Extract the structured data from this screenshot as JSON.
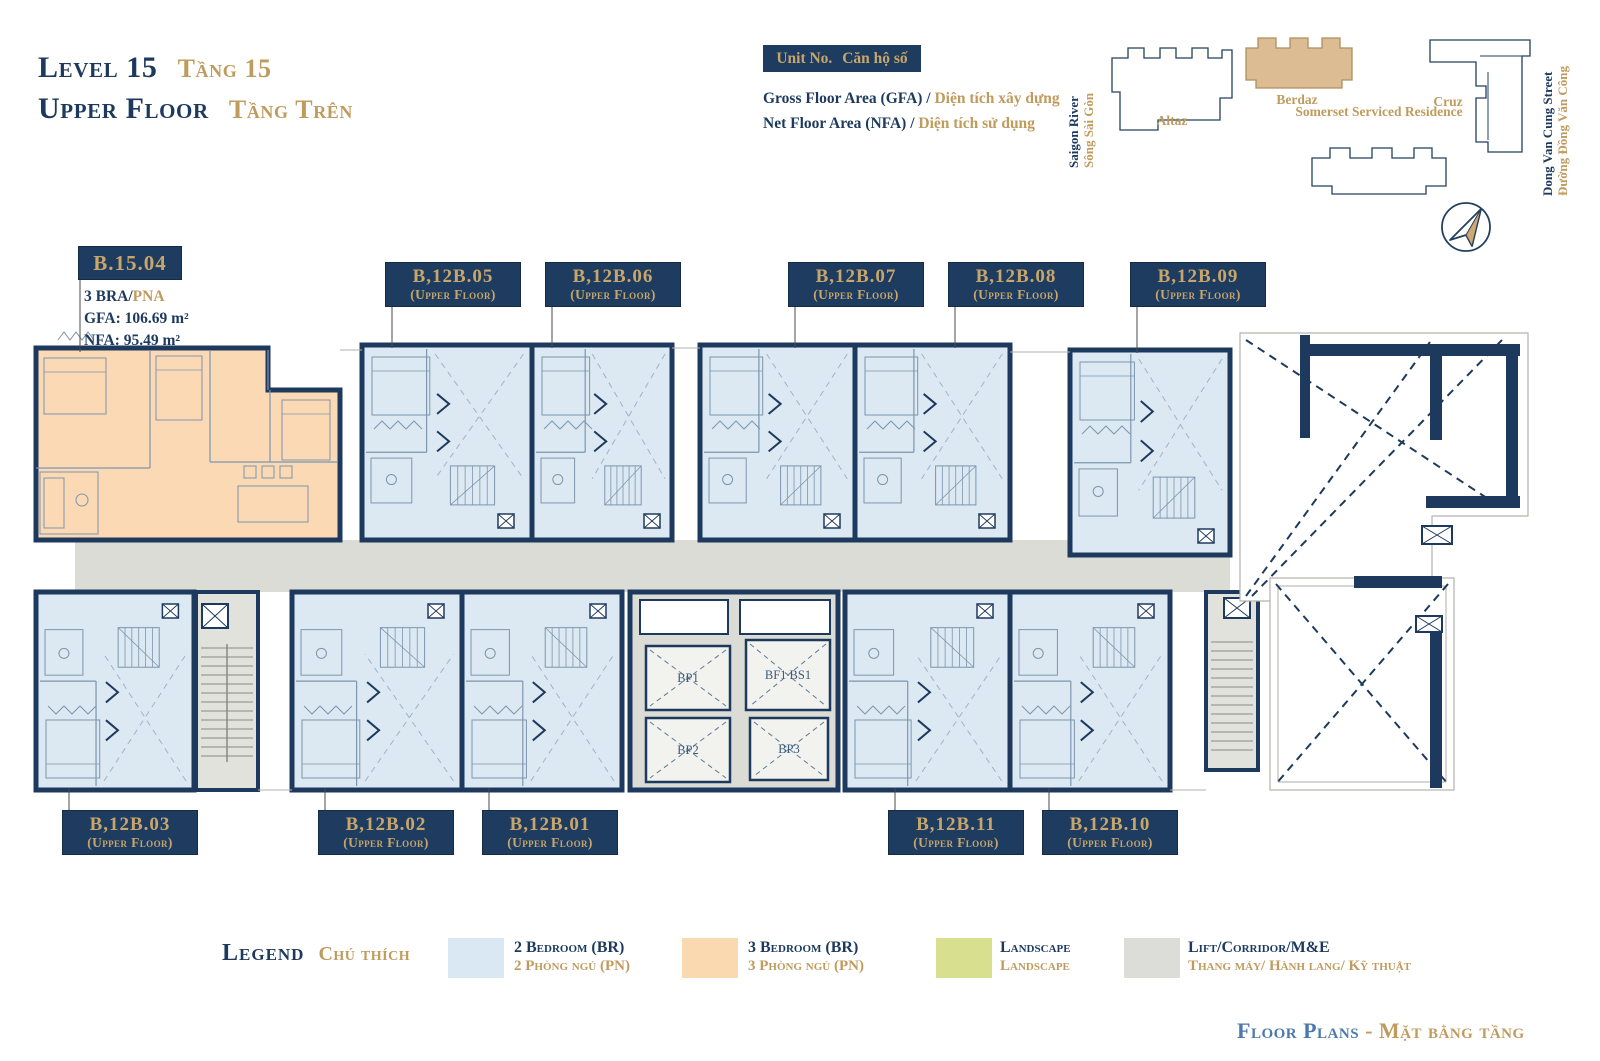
{
  "header": {
    "level_en": "Level 15",
    "level_vi": "Tầng 15",
    "floor_en": "Upper Floor",
    "floor_vi": "Tầng Trên"
  },
  "key": {
    "unit_no_en": "Unit No.",
    "unit_no_vi": "Căn hộ số",
    "gfa_en": "Gross Floor Area (GFA) / ",
    "gfa_vi": "Diện tích xây dựng",
    "nfa_en": "Net Floor Area (NFA) / ",
    "nfa_vi": "Diện tích sử dụng"
  },
  "site_map": {
    "river_en": "Saigon River",
    "river_vi": "Sông Sài Gòn",
    "street_en": "Dong Van Cung Street",
    "street_vi": "Đường Đồng Văn Công",
    "buildings": [
      {
        "name": "Altaz",
        "highlight": false
      },
      {
        "name": "Berdaz",
        "highlight": true
      },
      {
        "name": "Somerset Serviced Residence",
        "highlight": false
      },
      {
        "name": "Cruz",
        "highlight": false
      }
    ]
  },
  "featured_unit": {
    "id": "B.15.04",
    "type_en": "3 BRA/",
    "type_vi": "PNA",
    "gfa": "GFA: 106.69 m²",
    "nfa": "NFA: 95.49 m²"
  },
  "plan": {
    "units": [
      {
        "id": "B,12B.05",
        "sub": "(Upper Floor)"
      },
      {
        "id": "B,12B.06",
        "sub": "(Upper Floor)"
      },
      {
        "id": "B,12B.07",
        "sub": "(Upper Floor)"
      },
      {
        "id": "B,12B.08",
        "sub": "(Upper Floor)"
      },
      {
        "id": "B,12B.09",
        "sub": "(Upper Floor)"
      },
      {
        "id": "B,12B.03",
        "sub": "(Upper Floor)"
      },
      {
        "id": "B,12B.02",
        "sub": "(Upper Floor)"
      },
      {
        "id": "B,12B.01",
        "sub": "(Upper Floor)"
      },
      {
        "id": "B,12B.11",
        "sub": "(Upper Floor)"
      },
      {
        "id": "B,12B.10",
        "sub": "(Upper Floor)"
      }
    ],
    "lifts": [
      {
        "label": "BP1"
      },
      {
        "label": "BP2"
      },
      {
        "label": "BF1 BS1"
      },
      {
        "label": "BP3"
      }
    ]
  },
  "legend": {
    "title_en": "Legend",
    "title_vi": "Chú thích",
    "items": [
      {
        "en": "2 Bedroom (BR)",
        "vi": "2 Phòng ngủ (PN)",
        "color": "#d9e8f2"
      },
      {
        "en": "3 Bedroom (BR)",
        "vi": "3 Phòng ngủ (PN)",
        "color": "#fad8b0"
      },
      {
        "en": "Landscape",
        "vi": "Landscape",
        "color": "#d8df8e"
      },
      {
        "en": "Lift/Corridor/M&E",
        "vi": "Thang máy/ Hành lang/ Kỹ thuật",
        "color": "#dcdcd8"
      }
    ]
  },
  "footer": {
    "en": "Floor Plans",
    "sep": " - ",
    "vi": "Mặt bằng tầng"
  },
  "colors": {
    "navy": "#1d3a5e",
    "gold": "#bf9b5e",
    "blue_2br": "#dce9f3",
    "peach_3br": "#fbd9b4",
    "gray_core": "#dcdcd6",
    "green": "#d8df8e",
    "steel_blue": "#4b79ae"
  }
}
